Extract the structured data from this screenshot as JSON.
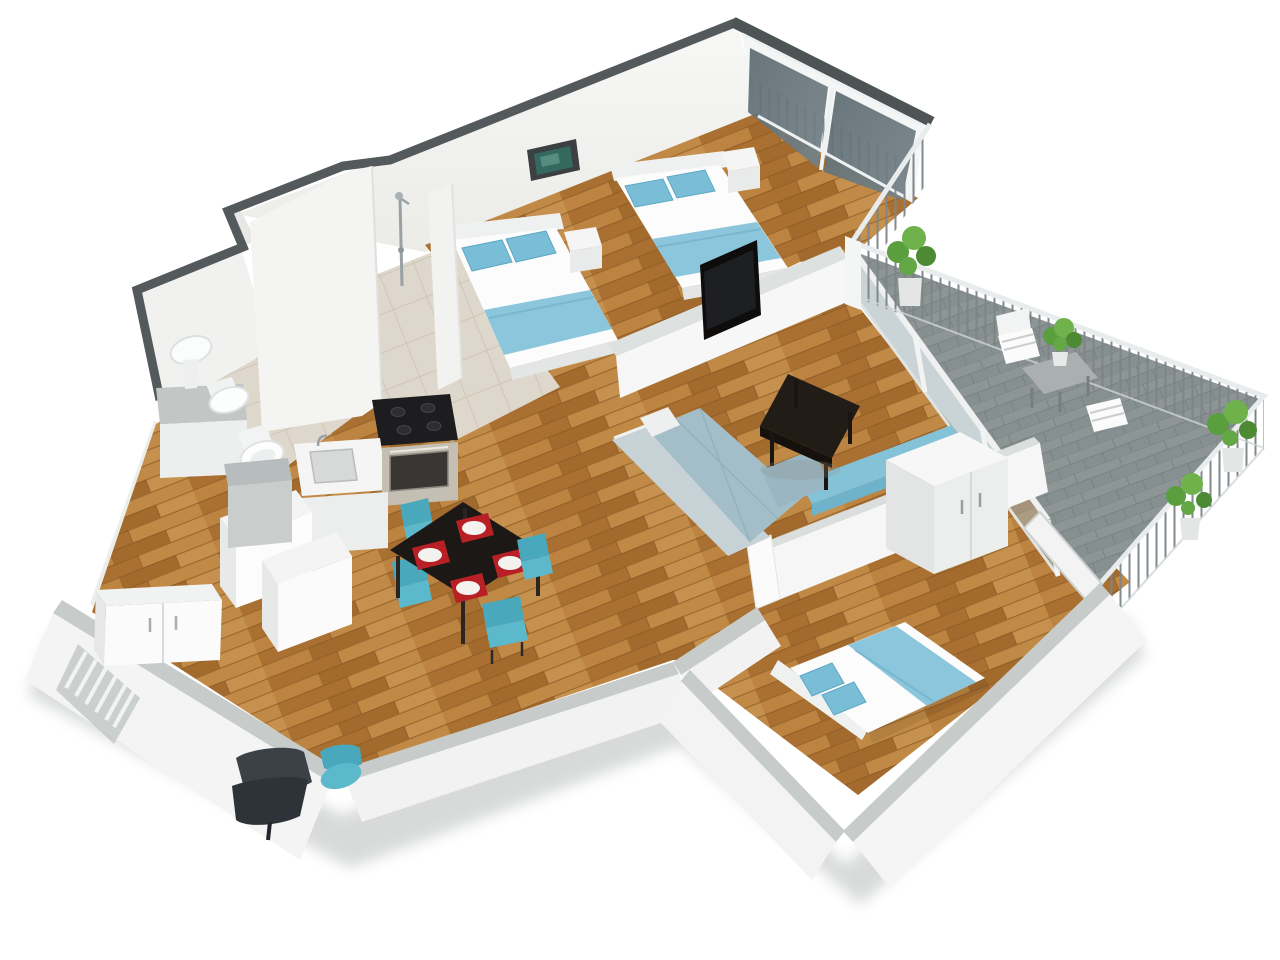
{
  "scene": {
    "kind": "3d-isometric-floor-plan-render",
    "style": "cutaway apartment, white walls, wooden floors, teal-blue soft furnishings",
    "background": "#ffffff"
  },
  "palette": {
    "wall_white": "#f6f6f4",
    "wall_top_dark": "#54595c",
    "wall_top_light": "#c7cccb",
    "wood_floor": "#b67d3c",
    "tile_floor": "#ded7cb",
    "balcony_floor": "#8e9595",
    "glass": "#6b7a80",
    "railing_bar": "#7c8487",
    "fabric_teal": "#84c2d8",
    "pillow_teal": "#79bdd6",
    "sofa_gray_teal": "#a3bdc9",
    "table_black": "#221c17",
    "plate_red": "#b92025",
    "chair_teal": "#5cb9cb",
    "plant_green": "#5a9e3e",
    "steel": "#9aa1a4"
  },
  "rooms": [
    {
      "name": "bedroom-main",
      "furniture": [
        "double-bed",
        "double-bed",
        "nightstand",
        "nightstand",
        "wall-picture",
        "tv-on-half-wall",
        "glass-sliding-doors"
      ]
    },
    {
      "name": "bathroom",
      "furniture": [
        "shower-fixture",
        "washbasin",
        "bidet",
        "toilet",
        "vanity-counter"
      ]
    },
    {
      "name": "kitchen",
      "furniture": [
        "cooktop",
        "oven",
        "sink-counter",
        "base-cabinet",
        "base-cabinet"
      ]
    },
    {
      "name": "dining-area",
      "furniture": [
        "black-dining-table",
        "teal-chair",
        "teal-chair",
        "teal-chair",
        "teal-chair",
        "place-setting-x4"
      ]
    },
    {
      "name": "living-room",
      "furniture": [
        "corner-sofa",
        "coffee-table",
        "sideboard",
        "wall-bench"
      ]
    },
    {
      "name": "bedroom-second",
      "furniture": [
        "double-bed"
      ]
    },
    {
      "name": "room-lower-left",
      "furniture": [
        "wardrobe",
        "dark-armchair",
        "teal-stool",
        "railing-outside"
      ]
    },
    {
      "name": "balcony",
      "furniture": [
        "bistro-table",
        "outdoor-chair",
        "outdoor-chair",
        "potted-plant",
        "potted-plant",
        "potted-plant",
        "potted-plant",
        "metal-railing",
        "glass-parapet"
      ]
    }
  ]
}
